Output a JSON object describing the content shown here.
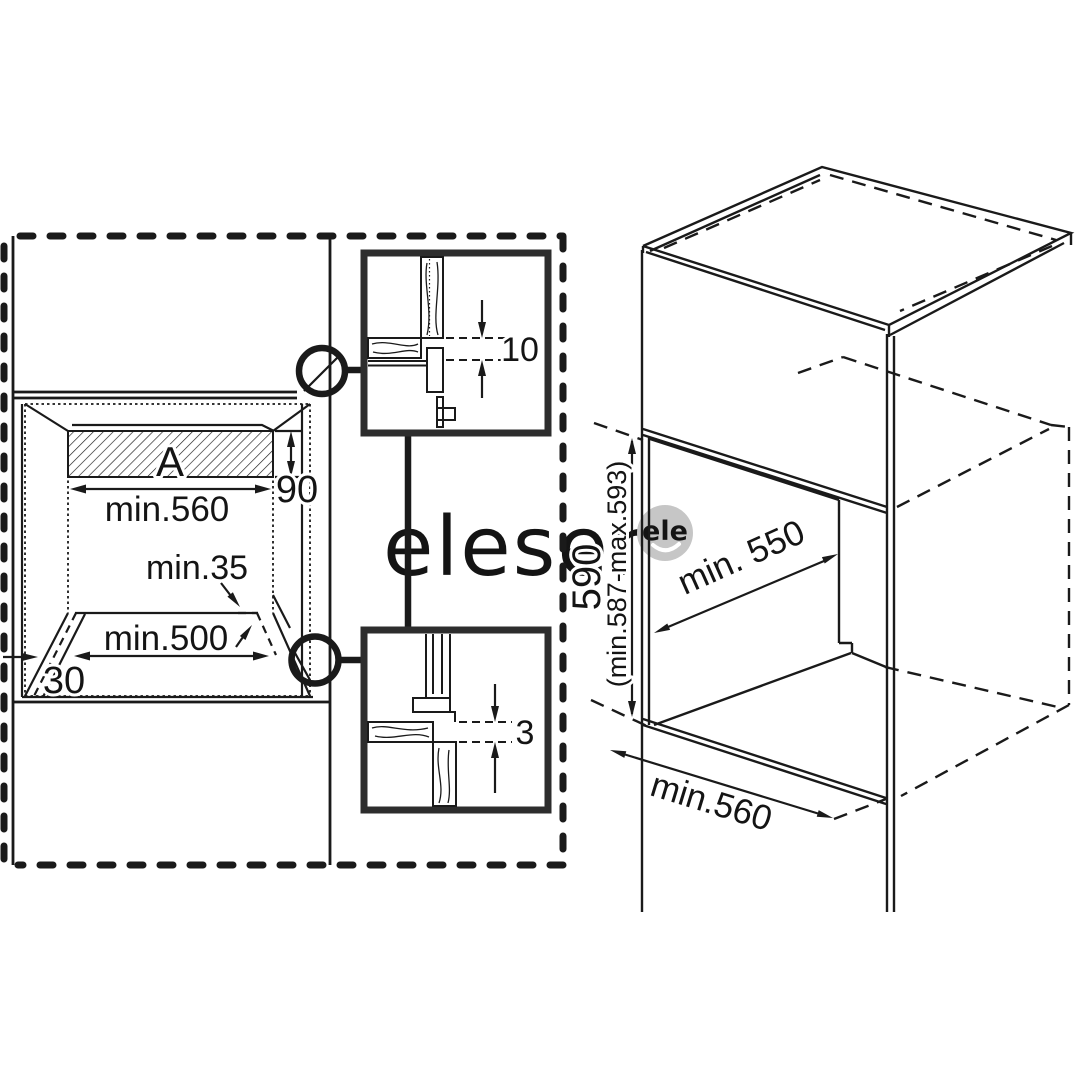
{
  "meta": {
    "background": "#ffffff",
    "line_color": "#1a1a1a",
    "detail_border_color": "#2d2d2d",
    "watermark_color": "#c6c6c6"
  },
  "watermark": {
    "text": "eleser",
    "badge_text": "ele"
  },
  "front_view": {
    "area_label": "A",
    "top_width_label": "min.560",
    "vent_height_label": "90",
    "rear_clearance_label": "min.35",
    "bottom_width_label": "min.500",
    "side_clearance_label": "30"
  },
  "detail_top": {
    "gap_label": "10"
  },
  "detail_bottom": {
    "gap_label": "3"
  },
  "iso_view": {
    "niche_height_label": "590",
    "niche_height_range_label": "(min.587-max.593)",
    "niche_depth_label": "min. 550",
    "niche_width_label": "min.560"
  }
}
